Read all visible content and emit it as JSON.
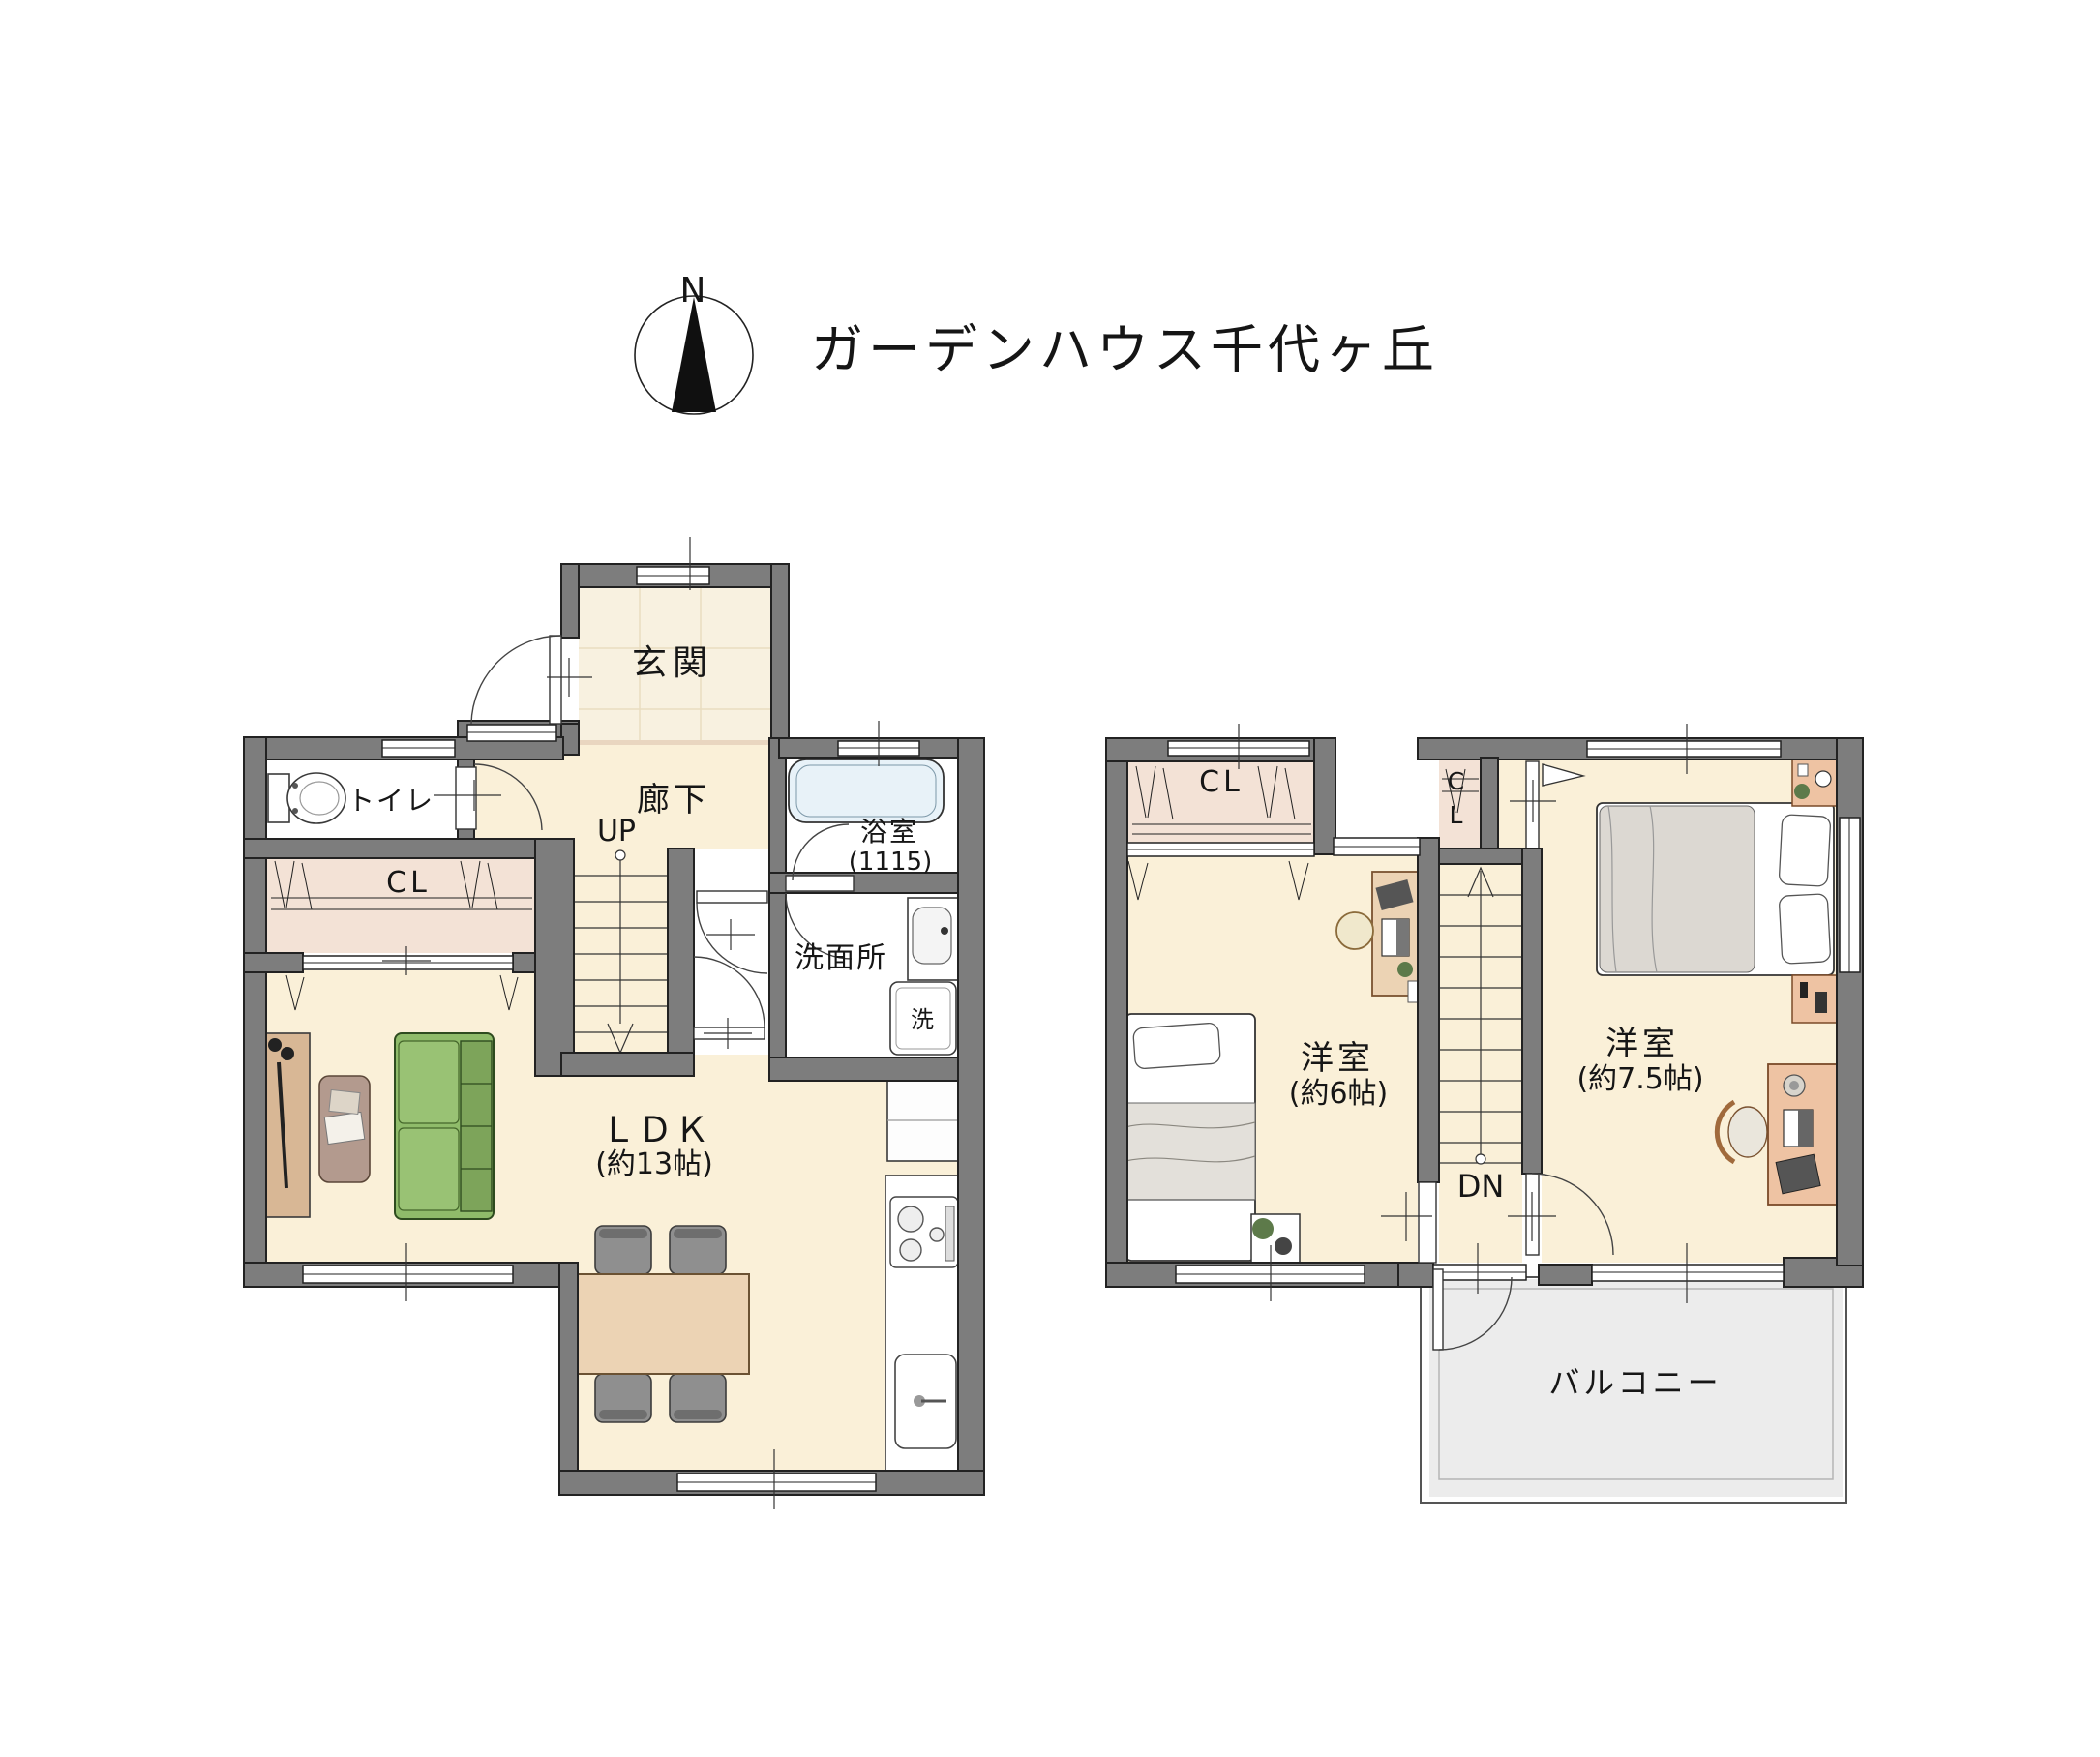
{
  "header": {
    "compass_n": "N",
    "title": "ガーデンハウス千代ヶ丘"
  },
  "colors": {
    "wall": "#7d7d7d",
    "wall_line": "#222222",
    "floor": "#faf0d8",
    "tile": "#f8f1e0",
    "tile_line": "#e9ddc0",
    "closet": "#f3e2d6",
    "step": "#e9d6c0",
    "wet": "#ffffff",
    "bath_water": "#e8f2f8",
    "balcony": "#ececec",
    "sofa": "#8fbb6a",
    "sofa_dark": "#7da45a",
    "wood": "#ecd3b4",
    "wood_dark": "#d8b795",
    "chair": "#8f8f8f",
    "salmon": "#eec3a3",
    "duvet": "#dcd8d2"
  },
  "floor1": {
    "rooms": {
      "genkan": "玄関",
      "hallway": "廊下",
      "stairs_up": "UP",
      "toilet": "トイレ",
      "closet": "CL",
      "bath": "浴室",
      "bath_size": "(1115)",
      "washroom": "洗面所",
      "washer": "洗",
      "ldk": "ＬＤＫ",
      "ldk_size": "(約13帖)"
    }
  },
  "floor2": {
    "rooms": {
      "closet_left": "CL",
      "closet_right": "CL",
      "bedroom_left": "洋室",
      "bedroom_left_size": "(約6帖)",
      "stairs_down": "DN",
      "bedroom_right": "洋室",
      "bedroom_right_size": "(約7.5帖)",
      "balcony": "バルコニー"
    }
  }
}
